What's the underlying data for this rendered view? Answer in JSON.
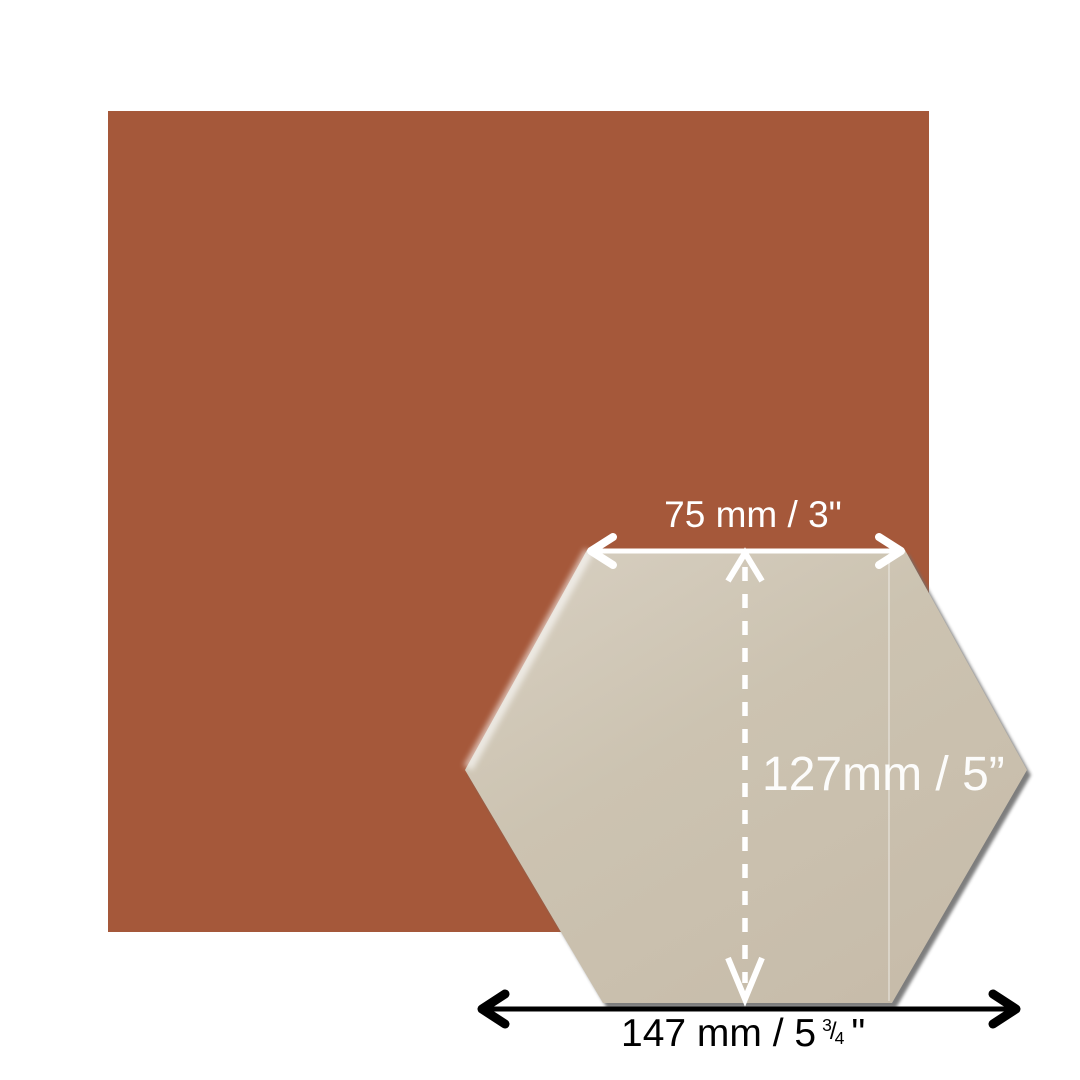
{
  "scene": {
    "background_color": "#FFFFFF",
    "square_tile": {
      "color": "#A5583A"
    },
    "hex_tile": {
      "color": "#CCC3B1",
      "highlight_color": "#FFFFFF",
      "shadow_color": "#6F6F6F"
    }
  },
  "dimensions": {
    "top_width": {
      "label": "75 mm / 3\"",
      "text_color": "#FFFFFF"
    },
    "height": {
      "label": "127mm / 5”",
      "text_color": "#FFFFFF"
    },
    "full_width": {
      "prefix": "147 mm / 5",
      "fraction_numerator": "3",
      "fraction_slash": "/",
      "fraction_denominator": "4",
      "suffix": "\"",
      "text_color": "#000000"
    }
  }
}
